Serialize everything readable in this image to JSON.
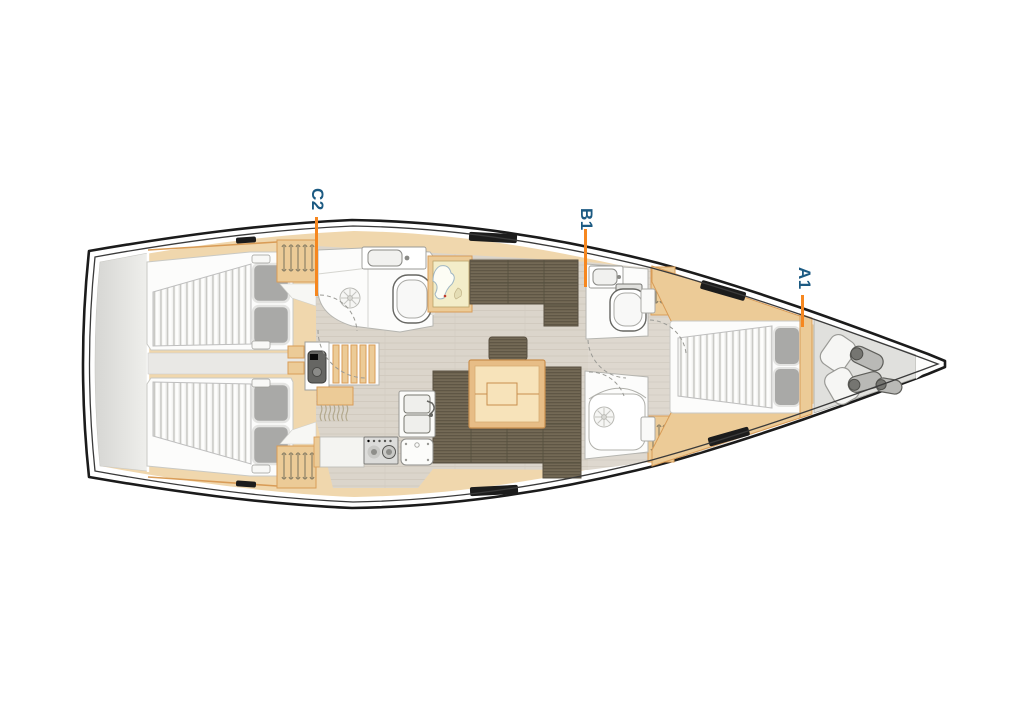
{
  "diagram": {
    "type": "sailboat-interior-deck-plan",
    "cabin_labels": [
      {
        "id": "C2",
        "text": "C2"
      },
      {
        "id": "B1",
        "text": "B1"
      },
      {
        "id": "A1",
        "text": "A1"
      }
    ],
    "colors": {
      "label_text": "#1c5a82",
      "leader_line": "#f6871f",
      "hull_outline": "#1b1b1b",
      "wood_trim": "#d99c57",
      "wood_fill": "#eccb97",
      "upholstery": "#6e6350",
      "salon_floor": "#dbd5cb",
      "mattress_stripe": "#c9c9c5",
      "transom_platform": "#e0e0dd"
    }
  }
}
